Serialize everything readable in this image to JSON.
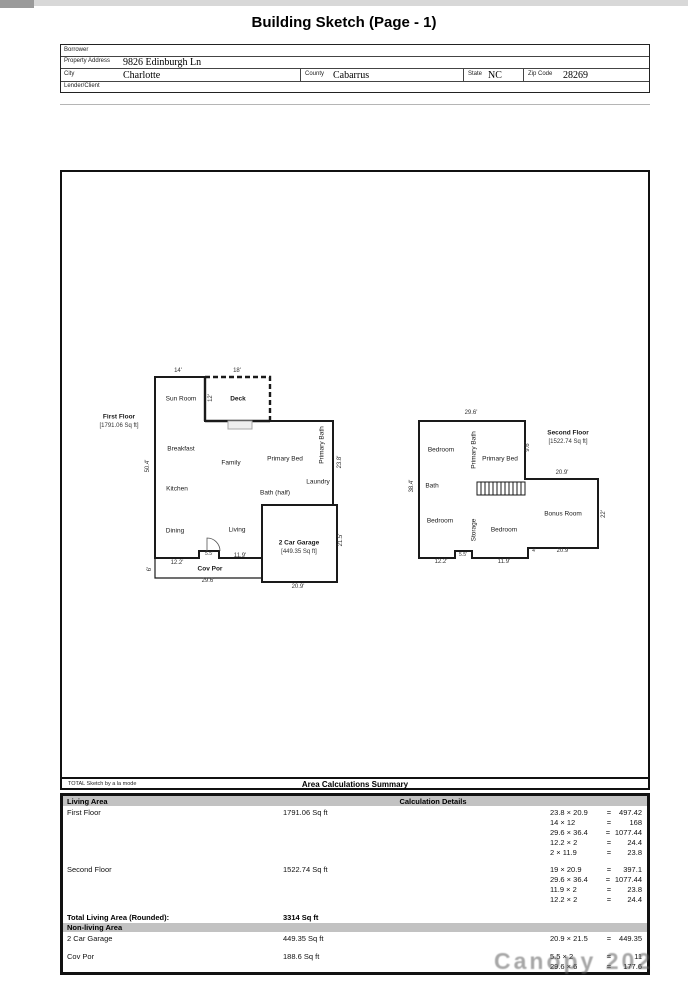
{
  "title": "Building Sketch (Page - 1)",
  "form": {
    "borrower_label": "Borrower",
    "property_address_label": "Property Address",
    "property_address_value": "9826 Edinburgh Ln",
    "city_label": "City",
    "city_value": "Charlotte",
    "county_label": "County",
    "county_value": "Cabarrus",
    "state_label": "State",
    "state_value": "NC",
    "zip_label": "Zip Code",
    "zip_value": "28269",
    "lender_label": "Lender/Client"
  },
  "sketch_footer": {
    "left": "TOTAL Sketch by a la mode",
    "title": "Area Calculations Summary"
  },
  "ff": {
    "title": "First Floor",
    "area": "[1791.06 Sq ft]",
    "rooms": {
      "sun_room": "Sun Room",
      "deck": "Deck",
      "breakfast": "Breakfast",
      "family": "Family",
      "primary_bed": "Primary Bed",
      "primary_bath": "Primary Bath",
      "kitchen": "Kitchen",
      "laundry": "Laundry",
      "bath_half": "Bath (half)",
      "dining": "Dining",
      "living": "Living",
      "garage": "2 Car Garage",
      "garage_area": "[449.35 Sq ft]",
      "cov_por": "Cov Por"
    },
    "dims": {
      "d14": "14'",
      "d18": "18'",
      "d12": "12'",
      "d50": "50.4'",
      "d238": "23.8'",
      "d215": "21.5'",
      "d122": "12.2'",
      "d55": "5.5'",
      "d119": "11.9'",
      "d296": "29.6'",
      "d209": "20.9'",
      "d6": "6'"
    }
  },
  "sf": {
    "title": "Second Floor",
    "area": "[1522.74 Sq ft]",
    "rooms": {
      "bedroom1": "Bedroom",
      "primary_bath": "Primary Bath",
      "primary_bed": "Primary Bed",
      "bath": "Bath",
      "bedroom2": "Bedroom",
      "storage": "Storage",
      "bedroom3": "Bedroom",
      "bonus": "Bonus Room"
    },
    "dims": {
      "d296": "29.6'",
      "d384": "38.4'",
      "d96": "9.6'",
      "d209a": "20.9'",
      "d22": "22'",
      "d209b": "20.9'",
      "d4": "4'",
      "d122": "12.2'",
      "d55": "5.5'",
      "d119": "11.9'"
    }
  },
  "table": {
    "eq": "=",
    "living_header": "Living Area",
    "calc_header": "Calculation Details",
    "rows": {
      "first_floor": {
        "label": "First Floor",
        "value": "1791.06 Sq ft"
      },
      "second_floor": {
        "label": "Second Floor",
        "value": "1522.74 Sq ft"
      },
      "total": {
        "label": "Total Living Area (Rounded):",
        "value": "3314 Sq ft"
      },
      "nonliving_header": "Non-living Area",
      "garage": {
        "label": "2 Car Garage",
        "value": "449.35 Sq ft"
      },
      "cov_por": {
        "label": "Cov Por",
        "value": "188.6 Sq ft"
      }
    },
    "calcs": {
      "ff": [
        {
          "e": "23.8 × 20.9",
          "r": "497.42"
        },
        {
          "e": "14 × 12",
          "r": "168"
        },
        {
          "e": "29.6 × 36.4",
          "r": "1077.44"
        },
        {
          "e": "12.2 × 2",
          "r": "24.4"
        },
        {
          "e": "2 × 11.9",
          "r": "23.8"
        }
      ],
      "sf": [
        {
          "e": "19 × 20.9",
          "r": "397.1"
        },
        {
          "e": "29.6 × 36.4",
          "r": "1077.44"
        },
        {
          "e": "11.9 × 2",
          "r": "23.8"
        },
        {
          "e": "12.2 × 2",
          "r": "24.4"
        }
      ],
      "garage": [
        {
          "e": "20.9 × 21.5",
          "r": "449.35"
        }
      ],
      "covpor": [
        {
          "e": "5.5 × 2",
          "r": "11"
        },
        {
          "e": "29.6 × 6",
          "r": "177.6"
        }
      ]
    }
  },
  "watermark": "Canopy 202"
}
